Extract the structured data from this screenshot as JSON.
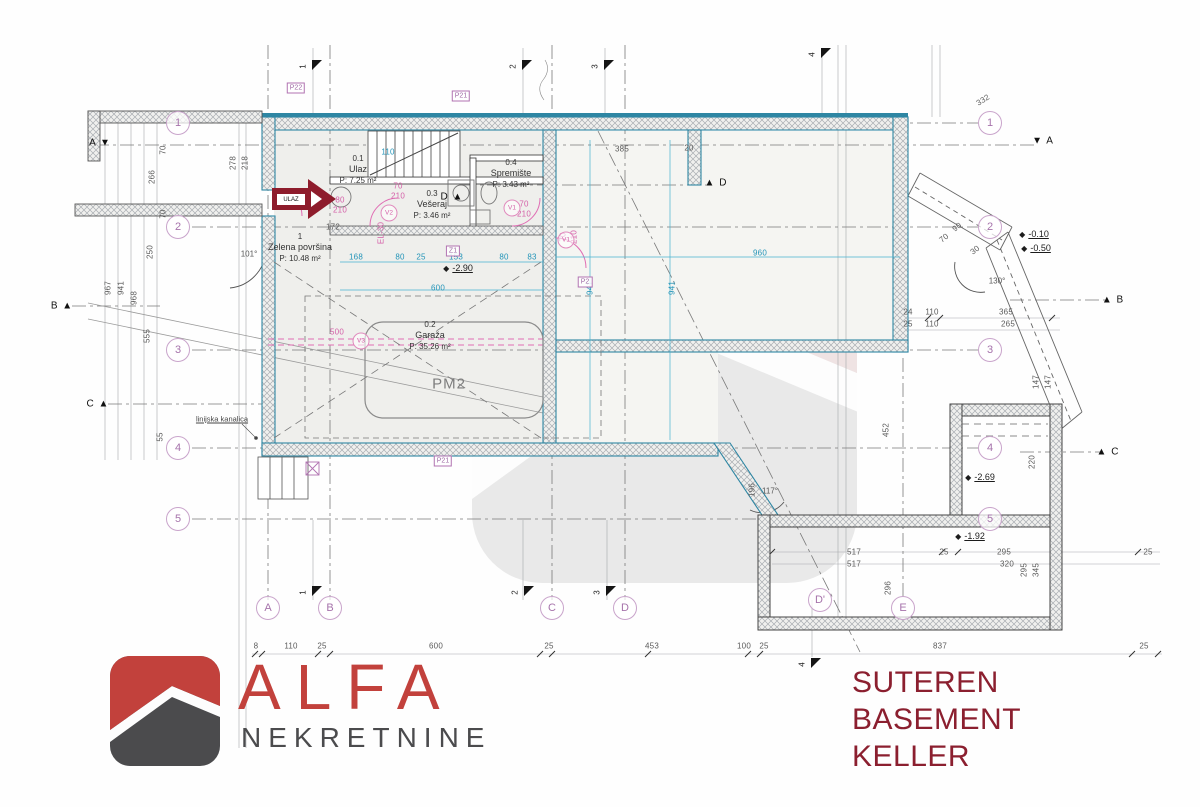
{
  "title": {
    "l1": "SUTEREN",
    "l2": "BASEMENT",
    "l3": "KELLER"
  },
  "logo": {
    "brand": "ALFA",
    "subtitle": "NEKRETNINE"
  },
  "entrance": {
    "label": "ULAZ"
  },
  "parking": {
    "label": "PM2",
    "x": 449,
    "y": 384
  },
  "rooms": [
    {
      "id": "0.1",
      "name": "Ulaz",
      "area": "P: 7.25 m²",
      "x": 358,
      "y": 170
    },
    {
      "id": "0.3",
      "name": "Vešeraj",
      "area": "P: 3.46 m²",
      "x": 432,
      "y": 205
    },
    {
      "id": "0.4",
      "name": "Spremište",
      "area": "P: 3.43 m²",
      "x": 511,
      "y": 174
    },
    {
      "id": "0.2",
      "name": "Garaža",
      "area": "P: 35.26 m²",
      "x": 430,
      "y": 336
    },
    {
      "id": "1",
      "name": "Zelena površina",
      "area": "P: 10.48 m²",
      "x": 300,
      "y": 248
    }
  ],
  "notes": [
    {
      "t": "linijska kanalica",
      "x": 222,
      "y": 419
    }
  ],
  "grid": {
    "lx": 178,
    "rx": 990,
    "numbers": [
      {
        "n": "1",
        "y": 123
      },
      {
        "n": "2",
        "y": 227
      },
      {
        "n": "3",
        "y": 350
      },
      {
        "n": "4",
        "y": 448
      },
      {
        "n": "5",
        "y": 519
      }
    ],
    "letters": [
      {
        "n": "A",
        "x": 268,
        "y": 608
      },
      {
        "n": "B",
        "x": 330,
        "y": 608
      },
      {
        "n": "C",
        "x": 552,
        "y": 608
      },
      {
        "n": "D",
        "x": 625,
        "y": 608
      },
      {
        "n": "D'",
        "x": 820,
        "y": 600
      },
      {
        "n": "E",
        "x": 903,
        "y": 608
      }
    ]
  },
  "section_flags": [
    {
      "n": "1",
      "x": 313,
      "y": 60
    },
    {
      "n": "2",
      "x": 523,
      "y": 60
    },
    {
      "n": "3",
      "x": 605,
      "y": 60
    },
    {
      "n": "4",
      "x": 822,
      "y": 48
    },
    {
      "n": "1",
      "x": 313,
      "y": 586
    },
    {
      "n": "2",
      "x": 525,
      "y": 586
    },
    {
      "n": "3",
      "x": 607,
      "y": 586
    },
    {
      "n": "4",
      "x": 812,
      "y": 658
    }
  ],
  "section_markers": [
    {
      "t": "A ▼",
      "x": 100,
      "y": 143
    },
    {
      "t": "▼ A",
      "x": 1043,
      "y": 141
    },
    {
      "t": "B ▲",
      "x": 62,
      "y": 306
    },
    {
      "t": "▲ B",
      "x": 1113,
      "y": 300
    },
    {
      "t": "C ▲",
      "x": 98,
      "y": 404
    },
    {
      "t": "▲ C",
      "x": 1108,
      "y": 452
    },
    {
      "t": "D ▲",
      "x": 452,
      "y": 197
    },
    {
      "t": "▲ D",
      "x": 716,
      "y": 183
    }
  ],
  "levels": [
    {
      "t": "-2.90",
      "x": 458,
      "y": 268
    },
    {
      "t": "-0.10",
      "x": 1034,
      "y": 234
    },
    {
      "t": "-0.50",
      "x": 1036,
      "y": 248
    },
    {
      "t": "-2.69",
      "x": 980,
      "y": 477
    },
    {
      "t": "-1.92",
      "x": 970,
      "y": 536
    }
  ],
  "angles": [
    {
      "t": "101°",
      "x": 249,
      "y": 254
    },
    {
      "t": "117°",
      "x": 770,
      "y": 491
    },
    {
      "t": "130°",
      "x": 997,
      "y": 281
    }
  ],
  "dims_gray": [
    {
      "t": "8",
      "x": 256,
      "y": 646
    },
    {
      "t": "110",
      "x": 291,
      "y": 646
    },
    {
      "t": "25",
      "x": 322,
      "y": 646
    },
    {
      "t": "600",
      "x": 436,
      "y": 646
    },
    {
      "t": "25",
      "x": 549,
      "y": 646
    },
    {
      "t": "453",
      "x": 652,
      "y": 646
    },
    {
      "t": "100",
      "x": 744,
      "y": 646
    },
    {
      "t": "25",
      "x": 764,
      "y": 646
    },
    {
      "t": "837",
      "x": 940,
      "y": 646
    },
    {
      "t": "25",
      "x": 1144,
      "y": 646
    },
    {
      "t": "967",
      "x": 108,
      "y": 288,
      "r": -90
    },
    {
      "t": "941",
      "x": 121,
      "y": 288,
      "r": -90
    },
    {
      "t": "968",
      "x": 134,
      "y": 298,
      "r": -90
    },
    {
      "t": "555",
      "x": 147,
      "y": 336,
      "r": -90
    },
    {
      "t": "55",
      "x": 160,
      "y": 437,
      "r": -90
    },
    {
      "t": "266",
      "x": 152,
      "y": 177,
      "r": -90
    },
    {
      "t": "70",
      "x": 163,
      "y": 150,
      "r": -90
    },
    {
      "t": "70",
      "x": 163,
      "y": 214,
      "r": -90
    },
    {
      "t": "250",
      "x": 150,
      "y": 252,
      "r": -90
    },
    {
      "t": "278",
      "x": 233,
      "y": 163,
      "r": -90
    },
    {
      "t": "218",
      "x": 245,
      "y": 163,
      "r": -90
    },
    {
      "t": "172",
      "x": 333,
      "y": 227
    },
    {
      "t": "385",
      "x": 622,
      "y": 149
    },
    {
      "t": "20",
      "x": 689,
      "y": 148
    },
    {
      "t": "24",
      "x": 908,
      "y": 312
    },
    {
      "t": "25",
      "x": 908,
      "y": 324
    },
    {
      "t": "110",
      "x": 932,
      "y": 312
    },
    {
      "t": "110",
      "x": 932,
      "y": 324
    },
    {
      "t": "365",
      "x": 1006,
      "y": 312
    },
    {
      "t": "265",
      "x": 1008,
      "y": 324
    },
    {
      "t": "147",
      "x": 1036,
      "y": 382,
      "r": -90
    },
    {
      "t": "147",
      "x": 1048,
      "y": 382,
      "r": -90
    },
    {
      "t": "220",
      "x": 1032,
      "y": 462,
      "r": -90
    },
    {
      "t": "452",
      "x": 886,
      "y": 430,
      "r": -90
    },
    {
      "t": "296",
      "x": 888,
      "y": 588,
      "r": -90
    },
    {
      "t": "196",
      "x": 752,
      "y": 490,
      "r": -90
    },
    {
      "t": "295",
      "x": 1024,
      "y": 570,
      "r": -90
    },
    {
      "t": "345",
      "x": 1036,
      "y": 570,
      "r": -90
    },
    {
      "t": "517",
      "x": 854,
      "y": 552
    },
    {
      "t": "517",
      "x": 854,
      "y": 564
    },
    {
      "t": "25",
      "x": 944,
      "y": 552
    },
    {
      "t": "295",
      "x": 1004,
      "y": 552
    },
    {
      "t": "320",
      "x": 1007,
      "y": 564
    },
    {
      "t": "25",
      "x": 1148,
      "y": 552
    },
    {
      "t": "332",
      "x": 983,
      "y": 100,
      "r": -32
    },
    {
      "t": "90",
      "x": 957,
      "y": 227,
      "r": -38
    },
    {
      "t": "70",
      "x": 944,
      "y": 238,
      "r": -38
    },
    {
      "t": "30",
      "x": 975,
      "y": 250,
      "r": -38
    }
  ],
  "dims_cyan": [
    {
      "t": "168",
      "x": 356,
      "y": 257
    },
    {
      "t": "80",
      "x": 400,
      "y": 257
    },
    {
      "t": "25",
      "x": 421,
      "y": 257
    },
    {
      "t": "153",
      "x": 456,
      "y": 257
    },
    {
      "t": "80",
      "x": 504,
      "y": 257
    },
    {
      "t": "83",
      "x": 532,
      "y": 257
    },
    {
      "t": "960",
      "x": 760,
      "y": 253
    },
    {
      "t": "600",
      "x": 438,
      "y": 288
    },
    {
      "t": "110",
      "x": 388,
      "y": 152
    },
    {
      "t": "941",
      "x": 590,
      "y": 288,
      "r": -90
    },
    {
      "t": "941",
      "x": 672,
      "y": 288,
      "r": -90
    }
  ],
  "dims_pink": [
    {
      "t": "80",
      "x": 340,
      "y": 200
    },
    {
      "t": "210",
      "x": 340,
      "y": 210
    },
    {
      "t": "70",
      "x": 398,
      "y": 186
    },
    {
      "t": "210",
      "x": 398,
      "y": 196
    },
    {
      "t": "70",
      "x": 524,
      "y": 204
    },
    {
      "t": "210",
      "x": 524,
      "y": 214
    },
    {
      "t": "70",
      "x": 563,
      "y": 237,
      "r": -90
    },
    {
      "t": "210",
      "x": 574,
      "y": 237,
      "r": -90
    },
    {
      "t": "500",
      "x": 337,
      "y": 332
    },
    {
      "t": "EL-30",
      "x": 381,
      "y": 233,
      "r": -90
    }
  ],
  "door_tags": [
    {
      "t": "V2",
      "x": 389,
      "y": 213
    },
    {
      "t": "V1",
      "x": 512,
      "y": 208
    },
    {
      "t": "V1",
      "x": 566,
      "y": 240
    },
    {
      "t": "V3",
      "x": 361,
      "y": 341
    }
  ],
  "ref_tags": [
    {
      "t": "P22",
      "x": 296,
      "y": 88
    },
    {
      "t": "P21",
      "x": 461,
      "y": 96
    },
    {
      "t": "Z1",
      "x": 453,
      "y": 251
    },
    {
      "t": "P21",
      "x": 443,
      "y": 461
    },
    {
      "t": "P2",
      "x": 585,
      "y": 282
    }
  ],
  "colors": {
    "accent_red": "#8e1c2c",
    "teal": "#2e86a3",
    "purple": "#b173b1",
    "pink": "#e06db4",
    "cyan": "#2ba8c9",
    "title_red": "#8b1f2f",
    "logo_red": "#c2413c",
    "logo_gray": "#4b4b4d"
  }
}
